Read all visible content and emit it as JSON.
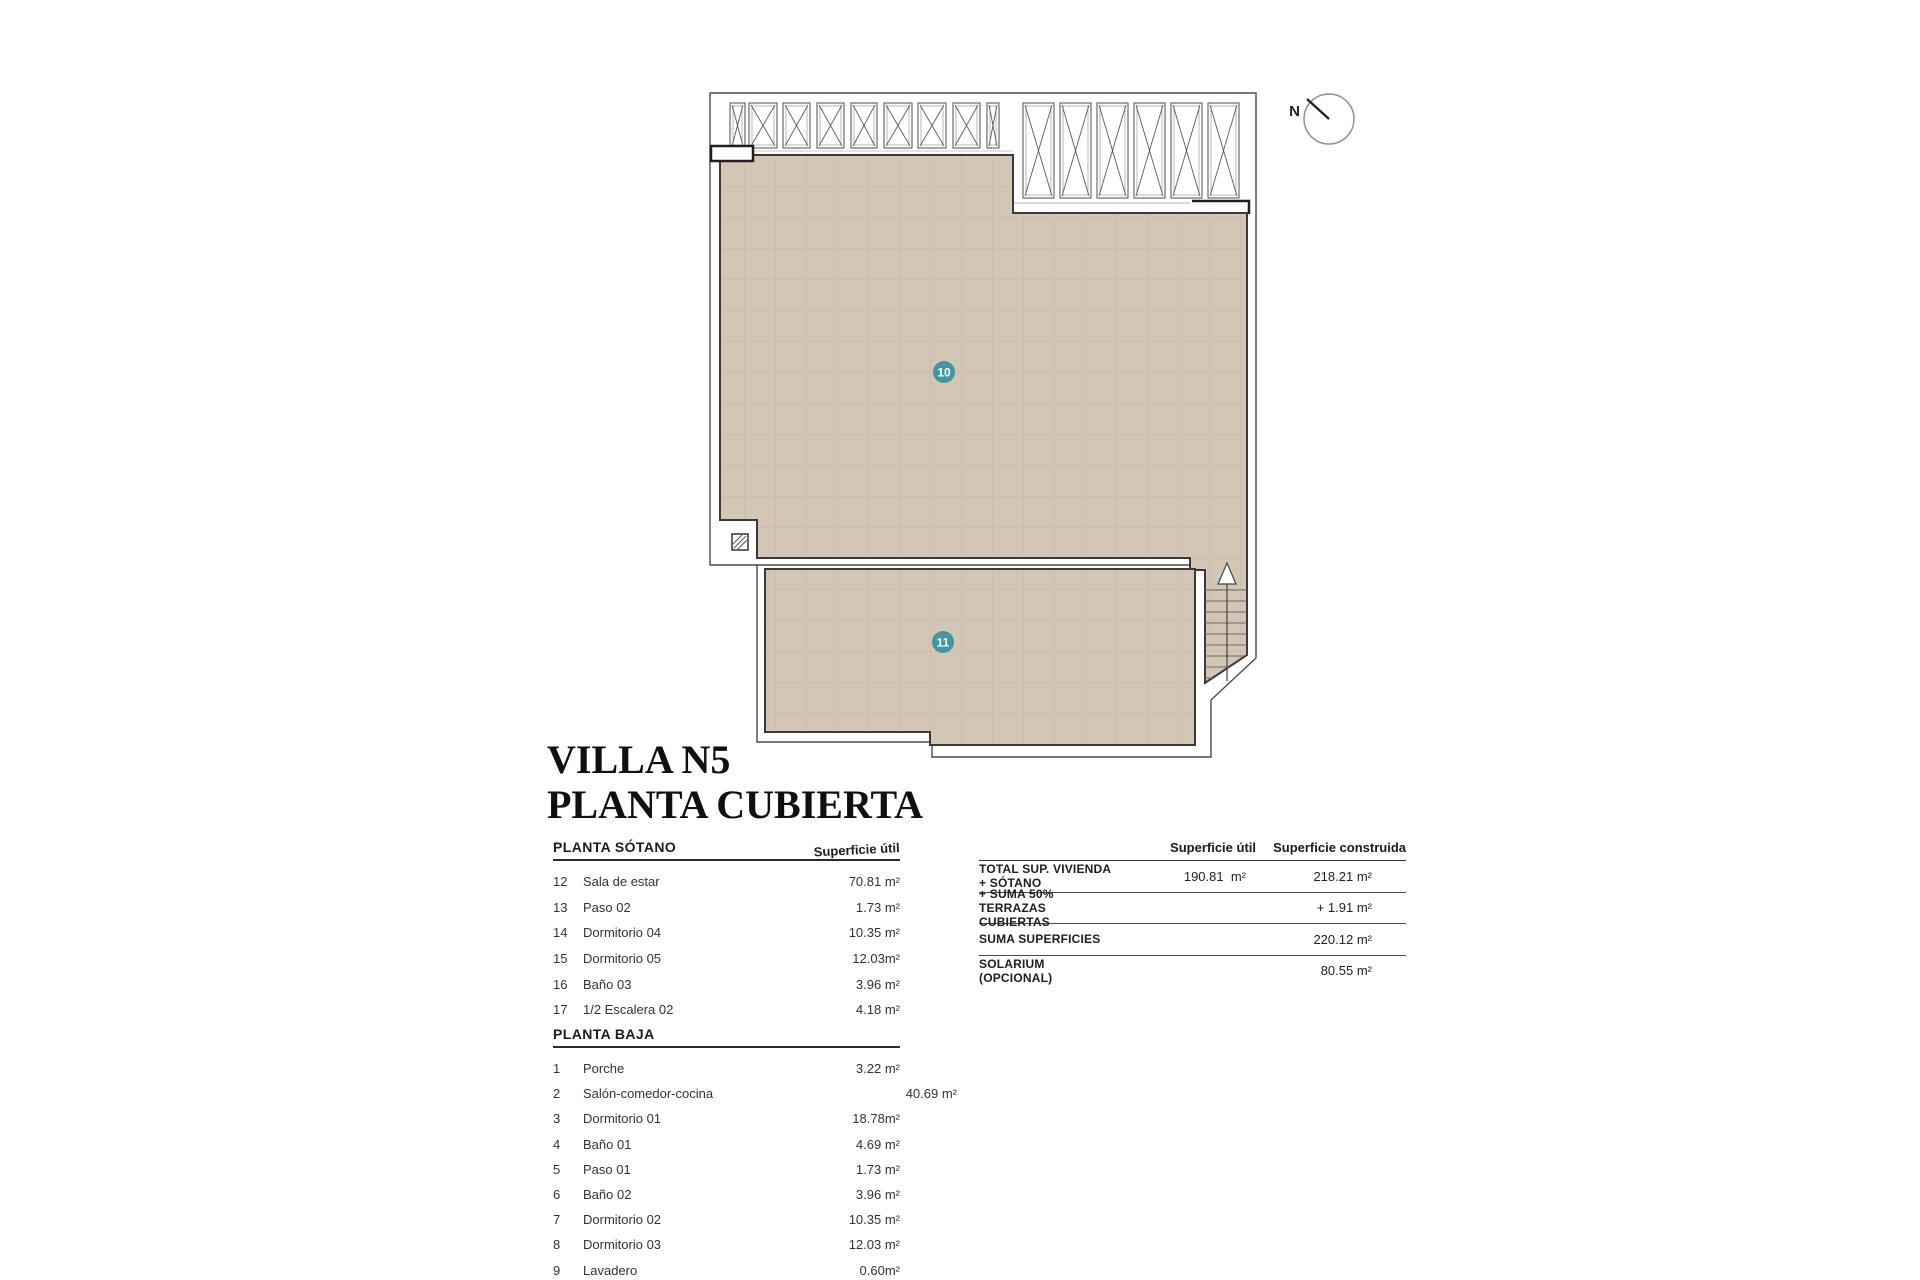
{
  "title": {
    "line1": "VILLA N5",
    "line2": "PLANTA CUBIERTA"
  },
  "compass": {
    "label": "N"
  },
  "plan": {
    "area10_label": "10",
    "area11_label": "11",
    "label_color": "#3e97a1",
    "roof_fill": "#d3c6b4"
  },
  "rooms_table": {
    "sections": [
      {
        "header": "PLANTA SÓTANO",
        "col_header": "Superficie útil",
        "rows": [
          {
            "num": "12",
            "name": "Sala de estar",
            "value": "70.81 m²"
          },
          {
            "num": "13",
            "name": "Paso 02",
            "value": "1.73 m²"
          },
          {
            "num": "14",
            "name": "Dormitorio 04",
            "value": "10.35 m²"
          },
          {
            "num": "15",
            "name": "Dormitorio 05",
            "value": "12.03m²"
          },
          {
            "num": "16",
            "name": "Baño 03",
            "value": "3.96 m²"
          },
          {
            "num": "17",
            "name": "1/2 Escalera 02",
            "value": "4.18 m²"
          }
        ]
      },
      {
        "header": "PLANTA BAJA",
        "col_header": "",
        "rows": [
          {
            "num": "1",
            "name": "Porche",
            "value": "3.22 m²"
          },
          {
            "num": "2",
            "name": "Salón-comedor-cocina",
            "value": "40.69 m²",
            "wide": true
          },
          {
            "num": "3",
            "name": "Dormitorio 01",
            "value": "18.78m²"
          },
          {
            "num": "4",
            "name": "Baño 01",
            "value": "4.69 m²"
          },
          {
            "num": "5",
            "name": "Paso 01",
            "value": "1.73 m²"
          },
          {
            "num": "6",
            "name": "Baño 02",
            "value": "3.96 m²"
          },
          {
            "num": "7",
            "name": "Dormitorio 02",
            "value": "10.35 m²"
          },
          {
            "num": "8",
            "name": "Dormitorio 03",
            "value": "12.03 m²"
          },
          {
            "num": "9",
            "name": "Lavadero",
            "value": "0.60m²"
          }
        ]
      }
    ]
  },
  "summary_table": {
    "col_util": "Superficie útil",
    "col_construida": "Superficie construida",
    "rows": [
      {
        "label": "TOTAL SUP. VIVIENDA + SÓTANO",
        "util": "190.81  m²",
        "construida": "218.21 m²"
      },
      {
        "label": "+ SUMA 50% TERRAZAS CUBIERTAS",
        "util": "",
        "construida": "+ 1.91 m²"
      },
      {
        "label": "SUMA SUPERFICIES",
        "util": "",
        "construida": "220.12 m²"
      },
      {
        "label": "SOLARIUM (OPCIONAL)",
        "util": "",
        "construida": "80.55 m²"
      }
    ]
  }
}
